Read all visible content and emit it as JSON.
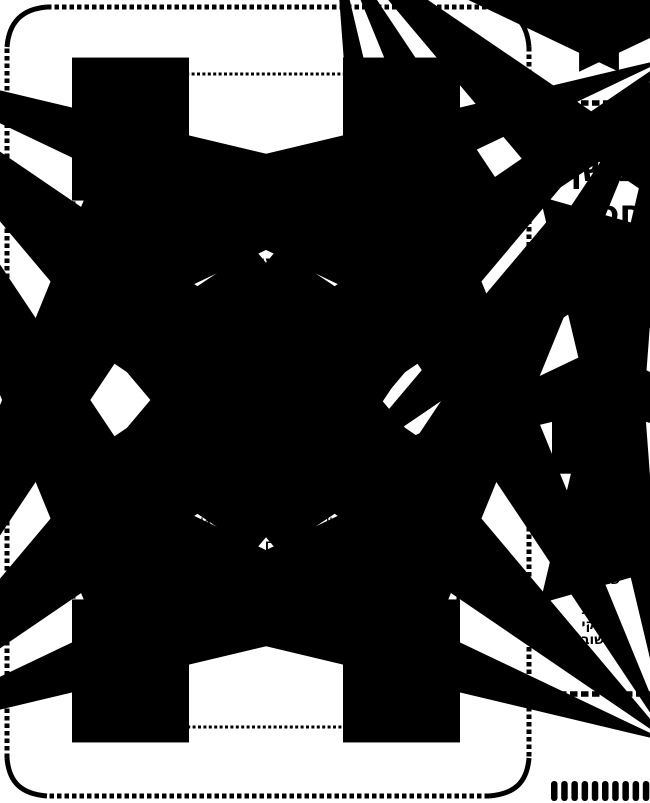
{
  "colors": {
    "ink": "#000000",
    "paper": "#ffffff"
  },
  "page": {
    "title_label": "ספר",
    "title": "משך חכמה",
    "subtitle": "מועדים",
    "topics_line1": "סוכות • פסח • קרבן פסח",
    "topics_line2": "שבועות • ר\"ה • יוה\"כ",
    "topics_line3": "פסקי התשובה",
    "dedication": {
      "occasion": "יו\"ל לרגל שמחת נישואי",
      "groom": "אברהם לייב",
      "groom_suffix": "נ\"ו",
      "bride": "ושרה דרעזיל",
      "bride_suffix": "תחי'",
      "city": "טרעס",
      "date": "ח\"י סיון תשס\"ו"
    }
  },
  "spine": {
    "title_label": "ספר",
    "title_line1": "משך",
    "title_line2": "חכמה",
    "subtitle": "מועדים",
    "topics": [
      "סוכות",
      "פסח",
      "קרבן פסח",
      "שבועות",
      "ר\"ה",
      "יוה\"כ",
      "פסקי",
      "התשובה"
    ]
  }
}
